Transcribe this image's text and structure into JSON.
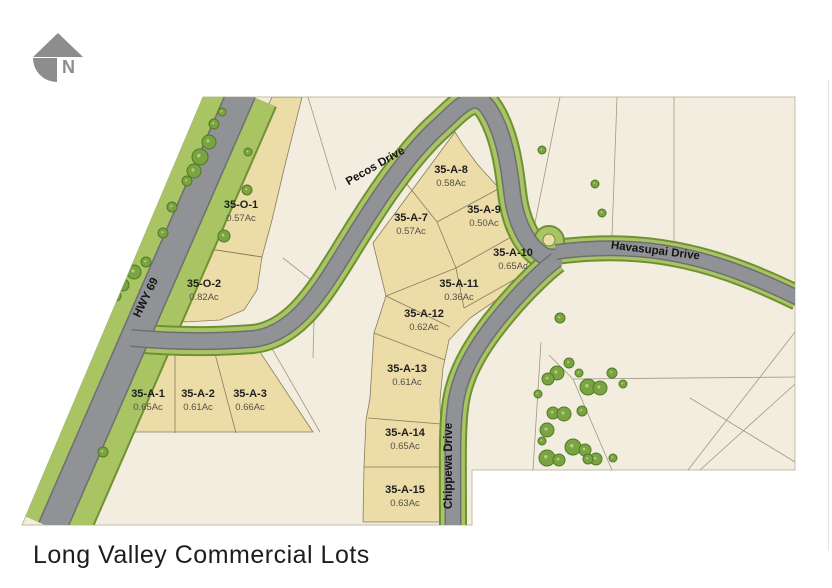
{
  "title": "Long Valley Commercial Lots",
  "north_indicator": {
    "label": "N"
  },
  "map": {
    "roads": [
      {
        "id": "hwy-69",
        "name": "HWY 69",
        "label_x": 149,
        "label_y": 299,
        "rotation": -64
      },
      {
        "id": "pecos-drive",
        "name": "Pecos Drive",
        "label_x": 377,
        "label_y": 169,
        "rotation": -30
      },
      {
        "id": "havasupai-drive",
        "name": "Havasupai Drive",
        "label_x": 655,
        "label_y": 254,
        "rotation": 7
      },
      {
        "id": "chippewa-drive",
        "name": "Chippewa Drive",
        "label_x": 452,
        "label_y": 466,
        "rotation": -90
      }
    ],
    "lots": [
      {
        "id": "35-O-1",
        "acreage": "0.57Ac",
        "x": 241,
        "y": 208
      },
      {
        "id": "35-O-2",
        "acreage": "0.82Ac",
        "x": 204,
        "y": 287
      },
      {
        "id": "35-A-1",
        "acreage": "0.65Ac",
        "x": 148,
        "y": 397
      },
      {
        "id": "35-A-2",
        "acreage": "0.61Ac",
        "x": 198,
        "y": 397
      },
      {
        "id": "35-A-3",
        "acreage": "0.66Ac",
        "x": 250,
        "y": 397
      },
      {
        "id": "35-A-7",
        "acreage": "0.57Ac",
        "x": 411,
        "y": 221
      },
      {
        "id": "35-A-8",
        "acreage": "0.58Ac",
        "x": 451,
        "y": 173
      },
      {
        "id": "35-A-9",
        "acreage": "0.50Ac",
        "x": 484,
        "y": 213
      },
      {
        "id": "35-A-10",
        "acreage": "0.65Ac",
        "x": 513,
        "y": 256
      },
      {
        "id": "35-A-11",
        "acreage": "0.36Ac",
        "x": 459,
        "y": 287
      },
      {
        "id": "35-A-12",
        "acreage": "0.62Ac",
        "x": 424,
        "y": 317
      },
      {
        "id": "35-A-13",
        "acreage": "0.61Ac",
        "x": 407,
        "y": 372
      },
      {
        "id": "35-A-14",
        "acreage": "0.65Ac",
        "x": 405,
        "y": 436
      },
      {
        "id": "35-A-15",
        "acreage": "0.63Ac",
        "x": 405,
        "y": 493
      }
    ],
    "trees": [
      [
        222,
        112,
        4
      ],
      [
        214,
        124,
        5
      ],
      [
        209,
        142,
        7
      ],
      [
        200,
        157,
        8
      ],
      [
        194,
        171,
        7
      ],
      [
        187,
        181,
        5
      ],
      [
        172,
        207,
        5
      ],
      [
        163,
        233,
        5
      ],
      [
        146,
        262,
        5
      ],
      [
        134,
        272,
        7
      ],
      [
        123,
        285,
        6
      ],
      [
        116,
        296,
        5
      ],
      [
        103,
        452,
        5
      ],
      [
        248,
        152,
        4
      ],
      [
        247,
        190,
        5
      ],
      [
        224,
        236,
        6
      ],
      [
        542,
        150,
        4
      ],
      [
        595,
        184,
        4
      ],
      [
        602,
        213,
        4
      ],
      [
        560,
        318,
        5
      ],
      [
        569,
        363,
        5
      ],
      [
        557,
        373,
        7
      ],
      [
        548,
        379,
        6
      ],
      [
        579,
        373,
        4
      ],
      [
        612,
        373,
        5
      ],
      [
        588,
        387,
        8
      ],
      [
        600,
        388,
        7
      ],
      [
        623,
        384,
        4
      ],
      [
        538,
        394,
        4
      ],
      [
        553,
        413,
        6
      ],
      [
        564,
        414,
        7
      ],
      [
        582,
        411,
        5
      ],
      [
        547,
        430,
        7
      ],
      [
        542,
        441,
        4
      ],
      [
        573,
        447,
        8
      ],
      [
        585,
        450,
        6
      ],
      [
        547,
        458,
        8
      ],
      [
        559,
        460,
        6
      ],
      [
        596,
        459,
        6
      ],
      [
        613,
        458,
        4
      ],
      [
        588,
        459,
        5
      ]
    ],
    "parcel_lines": [
      [
        [
          308,
          97
        ],
        [
          336,
          190
        ]
      ],
      [
        [
          560,
          97
        ],
        [
          534,
          228
        ]
      ],
      [
        [
          617,
          97
        ],
        [
          612,
          237
        ]
      ],
      [
        [
          674,
          97
        ],
        [
          674,
          243
        ]
      ],
      [
        [
          263,
          333
        ],
        [
          320,
          432
        ]
      ],
      [
        [
          283,
          258
        ],
        [
          315,
          283
        ],
        [
          313,
          358
        ]
      ],
      [
        [
          541,
          342
        ],
        [
          533,
          470
        ]
      ],
      [
        [
          549,
          355
        ],
        [
          573,
          379
        ]
      ],
      [
        [
          573,
          379
        ],
        [
          795,
          377
        ]
      ],
      [
        [
          573,
          379
        ],
        [
          612,
          470
        ]
      ],
      [
        [
          795,
          332
        ],
        [
          688,
          470
        ]
      ],
      [
        [
          795,
          384
        ],
        [
          700,
          470
        ]
      ],
      [
        [
          690,
          398
        ],
        [
          795,
          462
        ]
      ]
    ],
    "lot_dividers": [
      [
        [
          175,
          351
        ],
        [
          175,
          433
        ]
      ],
      [
        [
          214,
          350
        ],
        [
          236,
          433
        ]
      ],
      [
        [
          203,
          248
        ],
        [
          262,
          257
        ]
      ],
      [
        [
          402,
          178
        ],
        [
          437,
          222
        ]
      ],
      [
        [
          437,
          222
        ],
        [
          500,
          188
        ]
      ],
      [
        [
          437,
          222
        ],
        [
          456,
          268
        ]
      ],
      [
        [
          456,
          268
        ],
        [
          529,
          227
        ]
      ],
      [
        [
          386,
          296
        ],
        [
          456,
          268
        ]
      ],
      [
        [
          456,
          268
        ],
        [
          464,
          308
        ]
      ],
      [
        [
          464,
          308
        ],
        [
          528,
          272
        ]
      ],
      [
        [
          386,
          296
        ],
        [
          450,
          327
        ]
      ],
      [
        [
          374,
          333
        ],
        [
          445,
          360
        ]
      ],
      [
        [
          368,
          418
        ],
        [
          441,
          424
        ]
      ],
      [
        [
          364,
          467
        ],
        [
          441,
          467
        ]
      ]
    ],
    "colors": {
      "page": "#ffffff",
      "map_background": "#f2edde",
      "lot_fill": "#ecdca8",
      "lot_stroke": "#8a7d5c",
      "road_gray": "#919296",
      "road_dark": "#6e6f72",
      "verge_green": "#a9c463",
      "verge_dark": "#6f9134",
      "tree_fill": "#79a441",
      "tree_stroke": "#4f7a26",
      "parcel_line": "#a39884",
      "north_gray": "#8d8d8d"
    }
  }
}
